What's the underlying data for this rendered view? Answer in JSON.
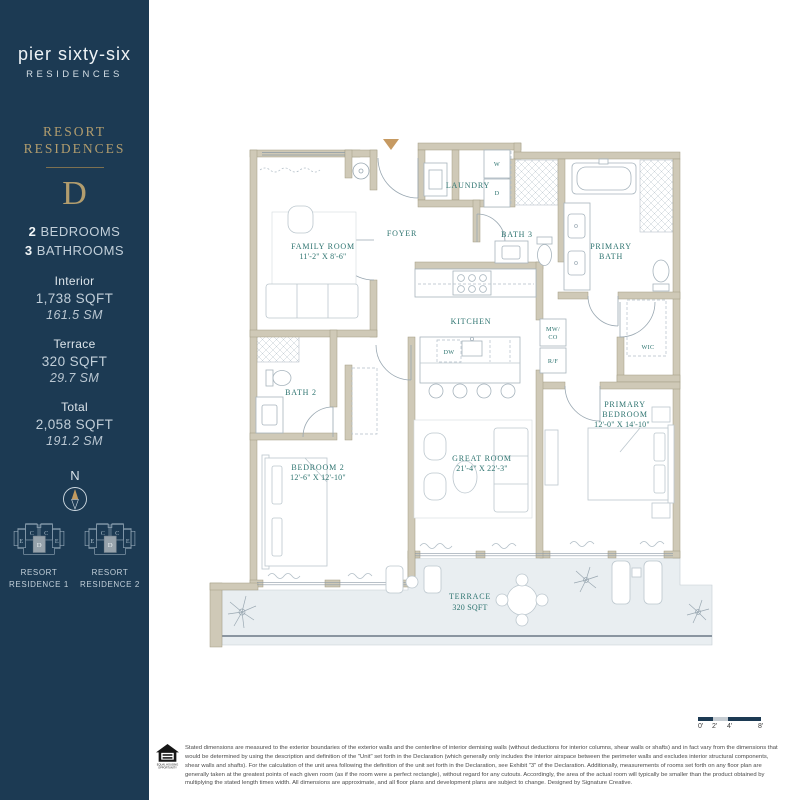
{
  "sidebar": {
    "brand": {
      "logo_line1": "pier sixty-six",
      "logo_line2": "RESIDENCES"
    },
    "collection_line1": "RESORT",
    "collection_line2": "RESIDENCES",
    "unit": "D",
    "bedrooms_num": "2",
    "bedrooms_label": " BEDROOMS",
    "bathrooms_num": "3",
    "bathrooms_label": " BATHROOMS",
    "stats": [
      {
        "label": "Interior",
        "sqft": "1,738 SQFT",
        "sm": "161.5 SM"
      },
      {
        "label": "Terrace",
        "sqft": "320 SQFT",
        "sm": "29.7 SM"
      },
      {
        "label": "Total",
        "sqft": "2,058 SQFT",
        "sm": "191.2 SM"
      }
    ],
    "compass_label": "N",
    "keyplans": [
      {
        "line1": "RESORT",
        "line2": "RESIDENCE 1",
        "units": {
          "c1": "C",
          "c2": "C",
          "e1": "E",
          "e2": "E",
          "d": "D"
        }
      },
      {
        "line1": "RESORT",
        "line2": "RESIDENCE 2",
        "units": {
          "c1": "C",
          "c2": "C",
          "e1": "E",
          "e2": "E",
          "d": "D"
        }
      }
    ]
  },
  "floorplan": {
    "rooms": {
      "family_room": {
        "name": "FAMILY ROOM",
        "dims": "11'-2\" X 8'-6\""
      },
      "foyer": {
        "name": "FOYER"
      },
      "laundry": {
        "name": "LAUNDRY"
      },
      "bath_3": {
        "name": "BATH 3"
      },
      "primary_bath": {
        "line1": "PRIMARY",
        "line2": "BATH"
      },
      "kitchen": {
        "name": "KITCHEN"
      },
      "wic": {
        "name": "WIC"
      },
      "bath_2": {
        "name": "BATH 2"
      },
      "bedroom_2": {
        "name": "BEDROOM 2",
        "dims": "12'-6\" X 12'-10\""
      },
      "great_room": {
        "name": "GREAT ROOM",
        "dims": "21'-4\" X 22'-3\""
      },
      "primary_bedroom": {
        "line1": "PRIMARY",
        "line2": "BEDROOM",
        "dims": "12'-0\" X 14'-10\""
      },
      "terrace": {
        "name": "TERRACE",
        "area": "320 SQFT"
      }
    },
    "appliances": {
      "washer": "W",
      "dryer": "D",
      "dishwasher": "DW",
      "microwave_line1": "MW/",
      "microwave_line2": "CO",
      "fridge": "R/F"
    }
  },
  "scalebar": {
    "ticks": [
      "0'",
      "2'",
      "4'",
      "8'"
    ]
  },
  "footer": {
    "equal_housing_line1": "EQUAL HOUSING",
    "equal_housing_line2": "OPPORTUNITY",
    "disclaimer": "Stated dimensions are measured to the exterior boundaries of the exterior walls and the centerline of interior demising walls (without deductions for interior columns, shear walls or shafts) and in fact vary from the dimensions that would be determined by using the description and definition of the \"Unit\" set forth in the Declaration (which generally only includes the interior airspace between the perimeter walls and excludes interior structural components, shear walls and shafts).  For the calculation of the unit area following the definition of the unit set forth in the Declaration, see Exhibit \"3\" of the Declaration. Additionally, measurements of rooms set forth on any floor plan are generally taken at the greatest points of each given room (as if the room were a perfect rectangle), without regard for any cutouts.  Accordingly, the area of the actual room will typically be smaller than the product obtained by multiplying the stated length times width. All dimensions are approximate, and all floor plans and development plans are subject to change. Designed by Signature Creative."
  },
  "colors": {
    "navy": "#1c3a53",
    "gold": "#b29d6e",
    "teal": "#2e7470",
    "wall_beige": "#cfc9b7",
    "terrace_fill": "#e9eef1"
  }
}
